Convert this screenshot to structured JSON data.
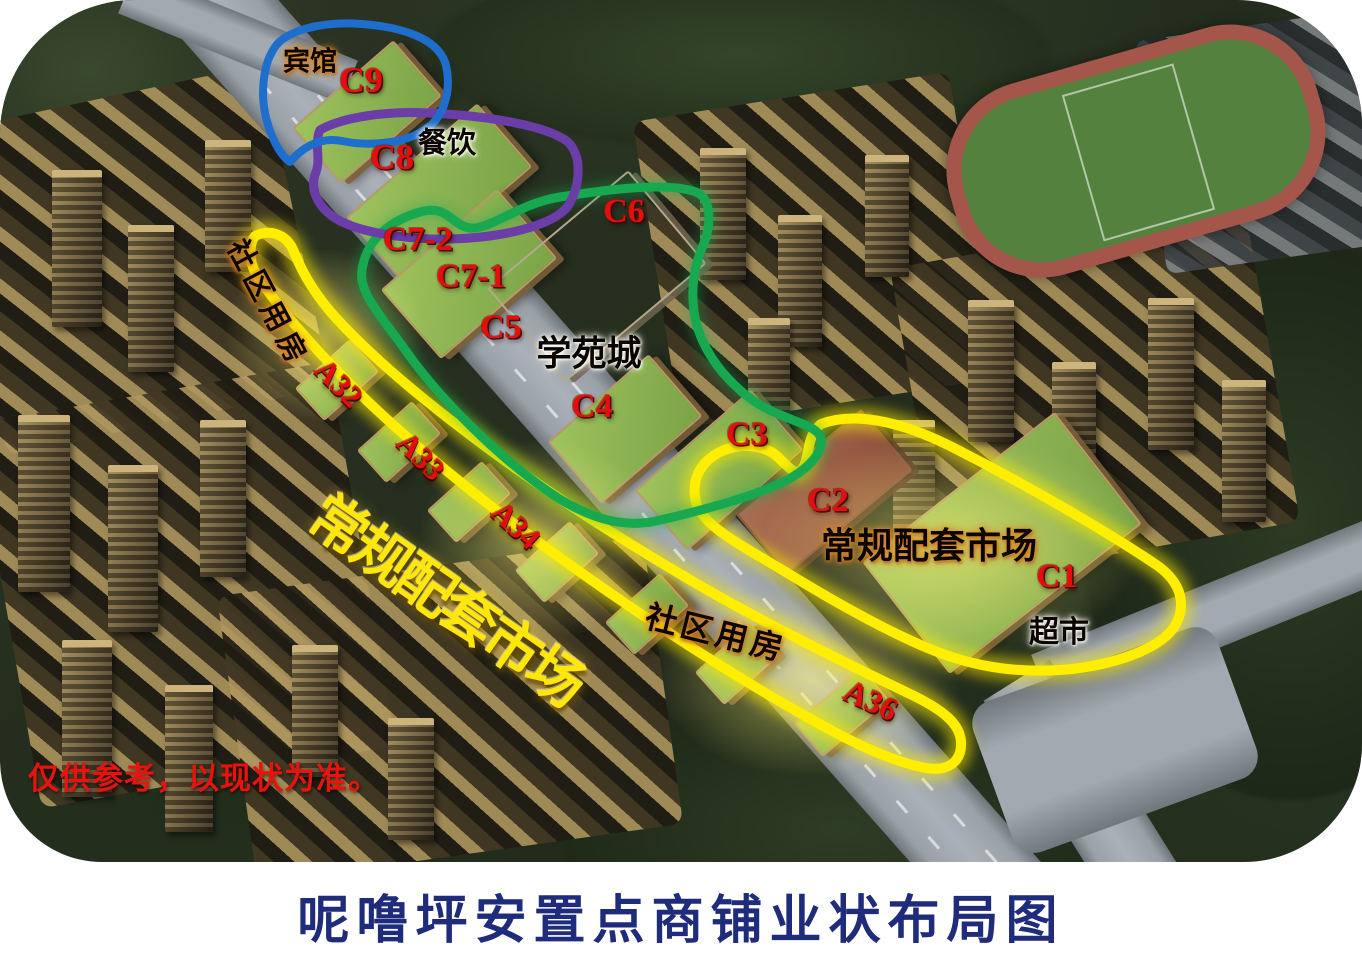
{
  "title": "呢噜坪安置点商铺业状布局图",
  "disclaimer": "仅供参考，以现状为准。",
  "labels": {
    "hotel": "宾馆",
    "c9": "C9",
    "c8": "C8",
    "dining": "餐饮",
    "c7_2": "C7-2",
    "c7_1": "C7-1",
    "c6": "C6",
    "c5": "C5",
    "xueyuan": "学苑城",
    "c4": "C4",
    "c3": "C3",
    "c2": "C2",
    "market_east": "常规配套市场",
    "c1": "C1",
    "supermarket": "超市",
    "community_1": "社区用房",
    "a32": "A32",
    "a33": "A33",
    "a34": "A34",
    "market_strip": "常规配套市场",
    "community_2": "社区用房",
    "a36": "A36"
  },
  "colors": {
    "zone_hotel": "#1e6ecd",
    "zone_dining": "#6b3da8",
    "zone_xueyuan": "#17a850",
    "zone_market": "#ffee00",
    "label_red": "#e50d0d",
    "strip_text_yellow": "#ffe70a",
    "title_navy": "#1f2b7b",
    "underline_purple": "#7b3aa4",
    "disclaimer_red": "#e9120d"
  }
}
